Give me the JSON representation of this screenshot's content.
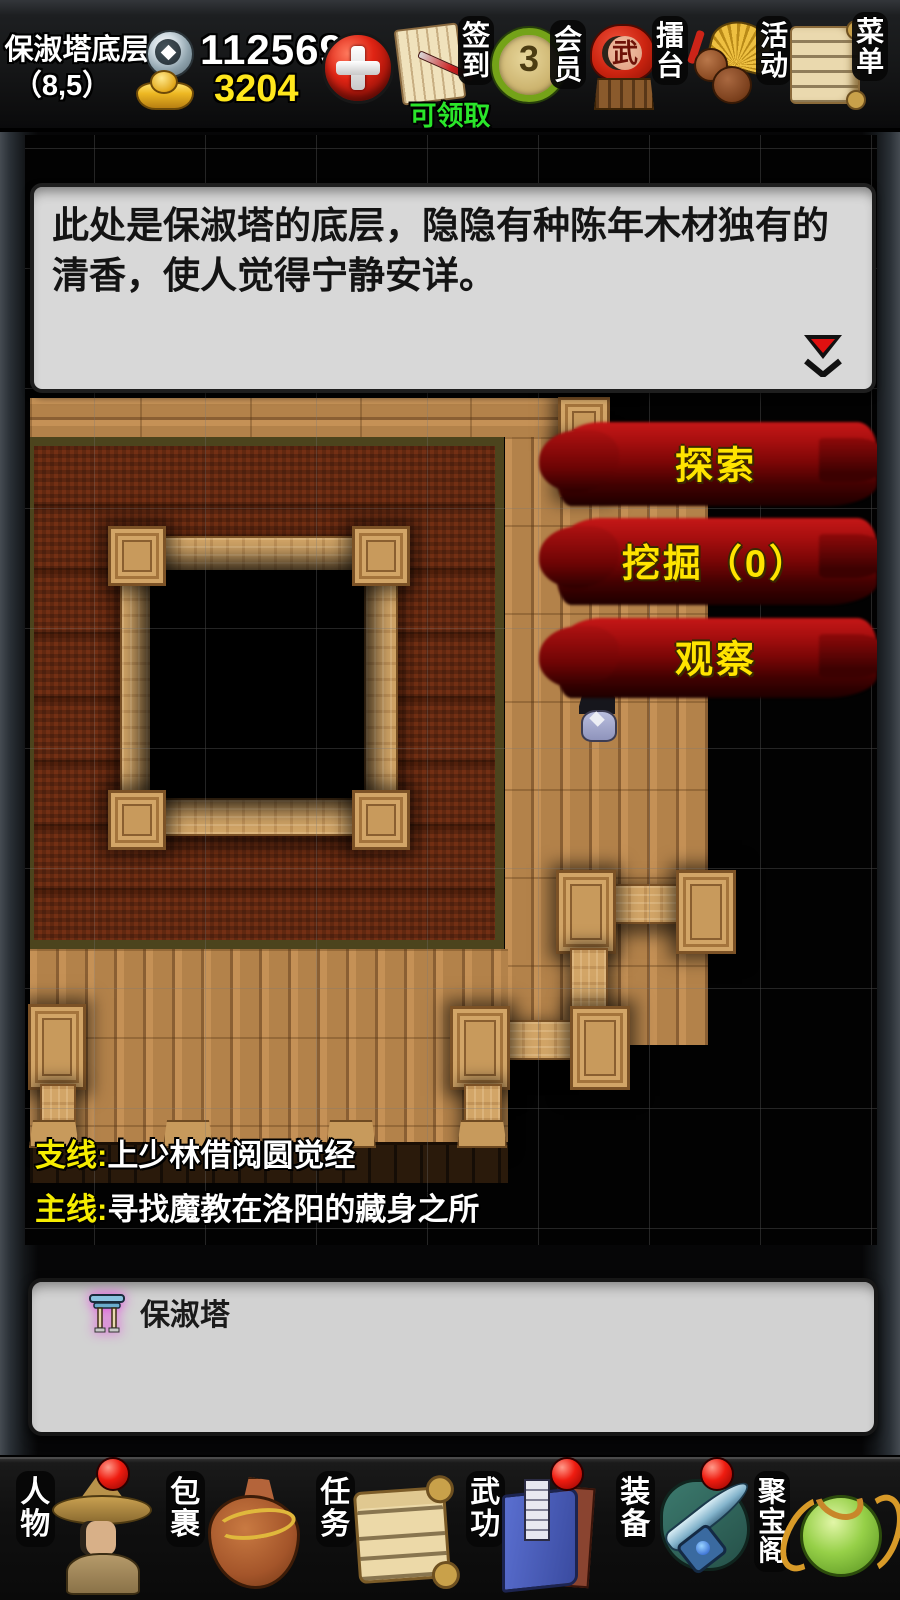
{
  "colors": {
    "accent_red": "#a80f0f",
    "button_text_yellow": "#ffe400",
    "money_yellow": "#ffe71c",
    "badge_green": "#2ae62a",
    "carpet_red": "#67290f",
    "wood_light": "#c59156"
  },
  "top_bar": {
    "location_name": "保淑塔底层",
    "coordinates": "（8,5）",
    "silver_amount": "112569",
    "gold_amount": "3204",
    "shortcuts": [
      {
        "name": "sign-in",
        "label": "签到",
        "badge": "可领取"
      },
      {
        "name": "member",
        "label": "会员",
        "value": "3"
      },
      {
        "name": "arena",
        "label": "擂台",
        "drum_char": "武"
      },
      {
        "name": "activity",
        "label": "活动"
      },
      {
        "name": "menu",
        "label": "菜单"
      }
    ]
  },
  "description_box": {
    "text": "此处是保淑塔的底层，隐隐有种陈年木材独有的清香，使人觉得宁静安详。"
  },
  "map": {
    "action_buttons": [
      {
        "label": "探索"
      },
      {
        "label": "挖掘（0）"
      },
      {
        "label": "观察"
      }
    ],
    "quest_lines": [
      {
        "prefix": "支线:",
        "text": "上少林借阅圆觉经"
      },
      {
        "prefix": "主线:",
        "text": "寻找魔教在洛阳的藏身之所"
      }
    ]
  },
  "location_panel": {
    "items": [
      {
        "icon": "gate-icon",
        "label": "保淑塔"
      }
    ]
  },
  "bottom_nav": {
    "items": [
      {
        "name": "character",
        "label": "人物",
        "badge": true
      },
      {
        "name": "bag",
        "label": "包裹",
        "badge": false
      },
      {
        "name": "quest",
        "label": "任务",
        "badge": false
      },
      {
        "name": "martial",
        "label": "武功",
        "badge": true
      },
      {
        "name": "equipment",
        "label": "装备",
        "badge": true
      },
      {
        "name": "treasure",
        "label": "聚宝阁",
        "badge": false
      }
    ]
  }
}
